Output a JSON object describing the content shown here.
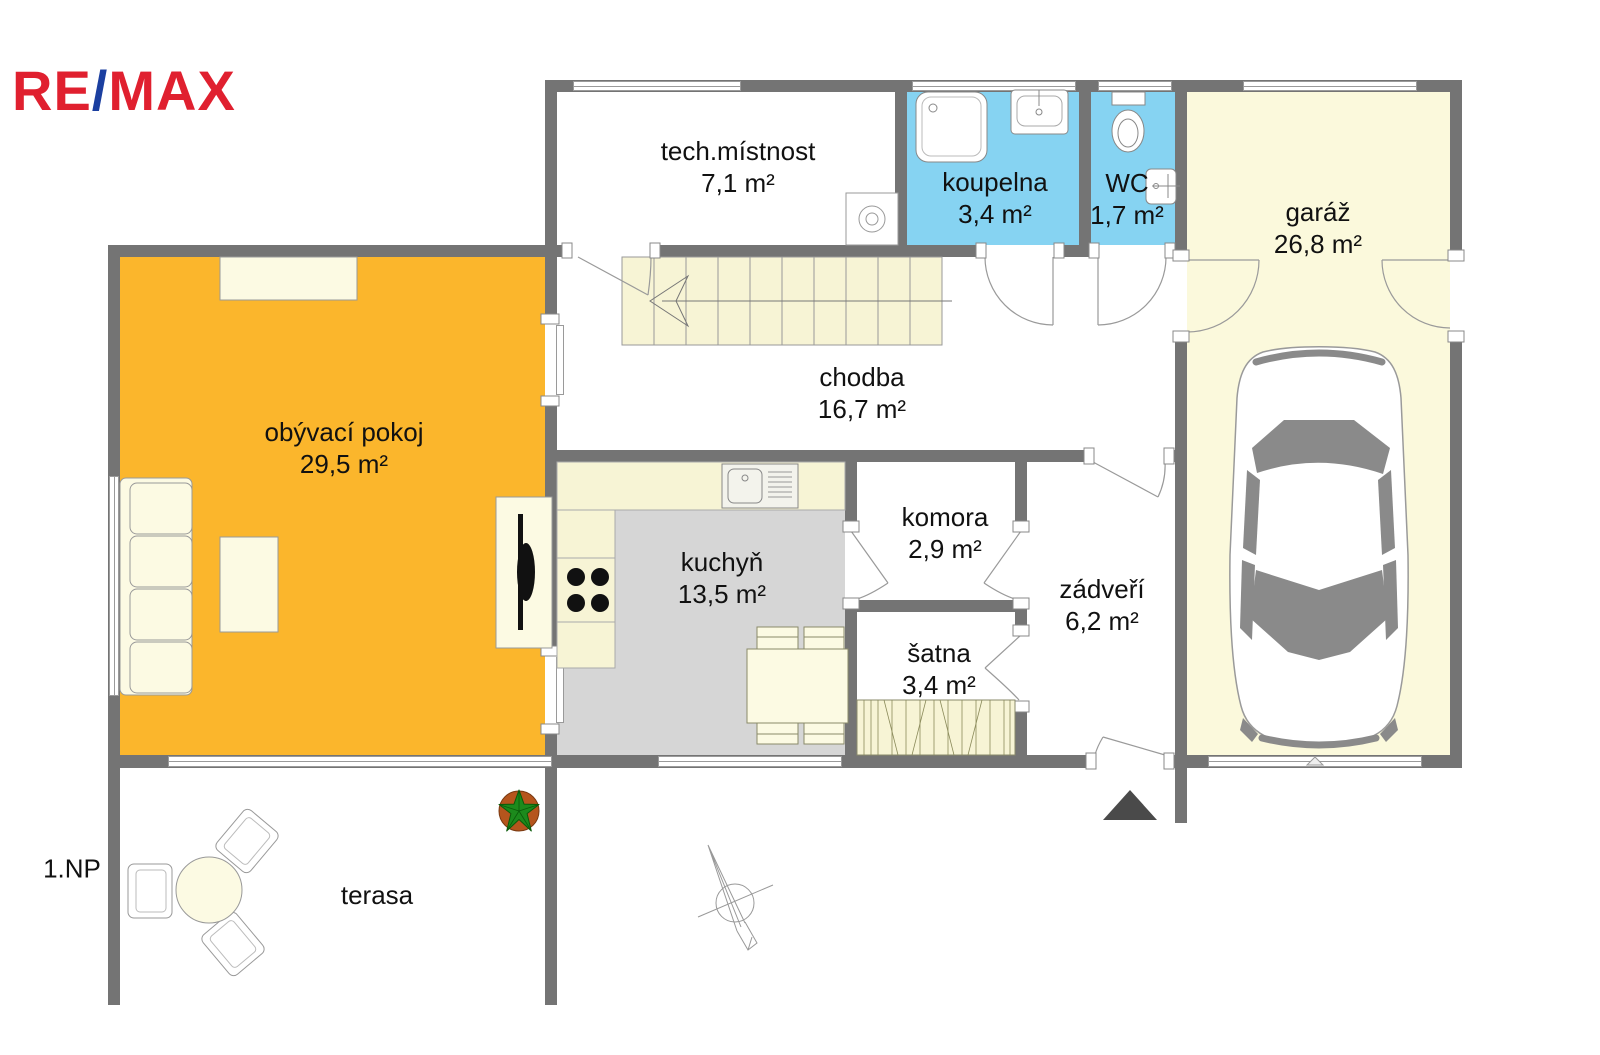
{
  "logo": {
    "part1": "RE",
    "part2": "/",
    "part3": "MAX"
  },
  "floor_label": "1.NP",
  "rooms": {
    "tech": {
      "name": "tech.místnost",
      "area": "7,1 m²"
    },
    "koupelna": {
      "name": "koupelna",
      "area": "3,4 m²"
    },
    "wc": {
      "name": "WC",
      "area": "1,7 m²"
    },
    "garaz": {
      "name": "garáž",
      "area": "26,8 m²"
    },
    "chodba": {
      "name": "chodba",
      "area": "16,7 m²"
    },
    "obyvaci": {
      "name": "obývací pokoj",
      "area": "29,5 m²"
    },
    "kuchyn": {
      "name": "kuchyň",
      "area": "13,5 m²"
    },
    "komora": {
      "name": "komora",
      "area": "2,9 m²"
    },
    "zadveri": {
      "name": "zádveří",
      "area": "6,2 m²"
    },
    "satna": {
      "name": "šatna",
      "area": "3,4 m²"
    },
    "terasa": {
      "name": "terasa"
    }
  },
  "colors": {
    "wall": "#747474",
    "living": "#FBB62C",
    "wet-room": "#86D3F2",
    "pale-room": "#FBF9DC",
    "kitchen-floor": "#D6D6D6",
    "furniture": "#FCFAE3",
    "counter": "#F7F4D5",
    "logo-red": "#E0202F",
    "logo-blue": "#1B3FA0",
    "entrance-marker": "#4A4A4A",
    "plant-pot": "#B5551D",
    "plant-green": "#1C8A1C",
    "car-glass": "#8A8A8A"
  }
}
